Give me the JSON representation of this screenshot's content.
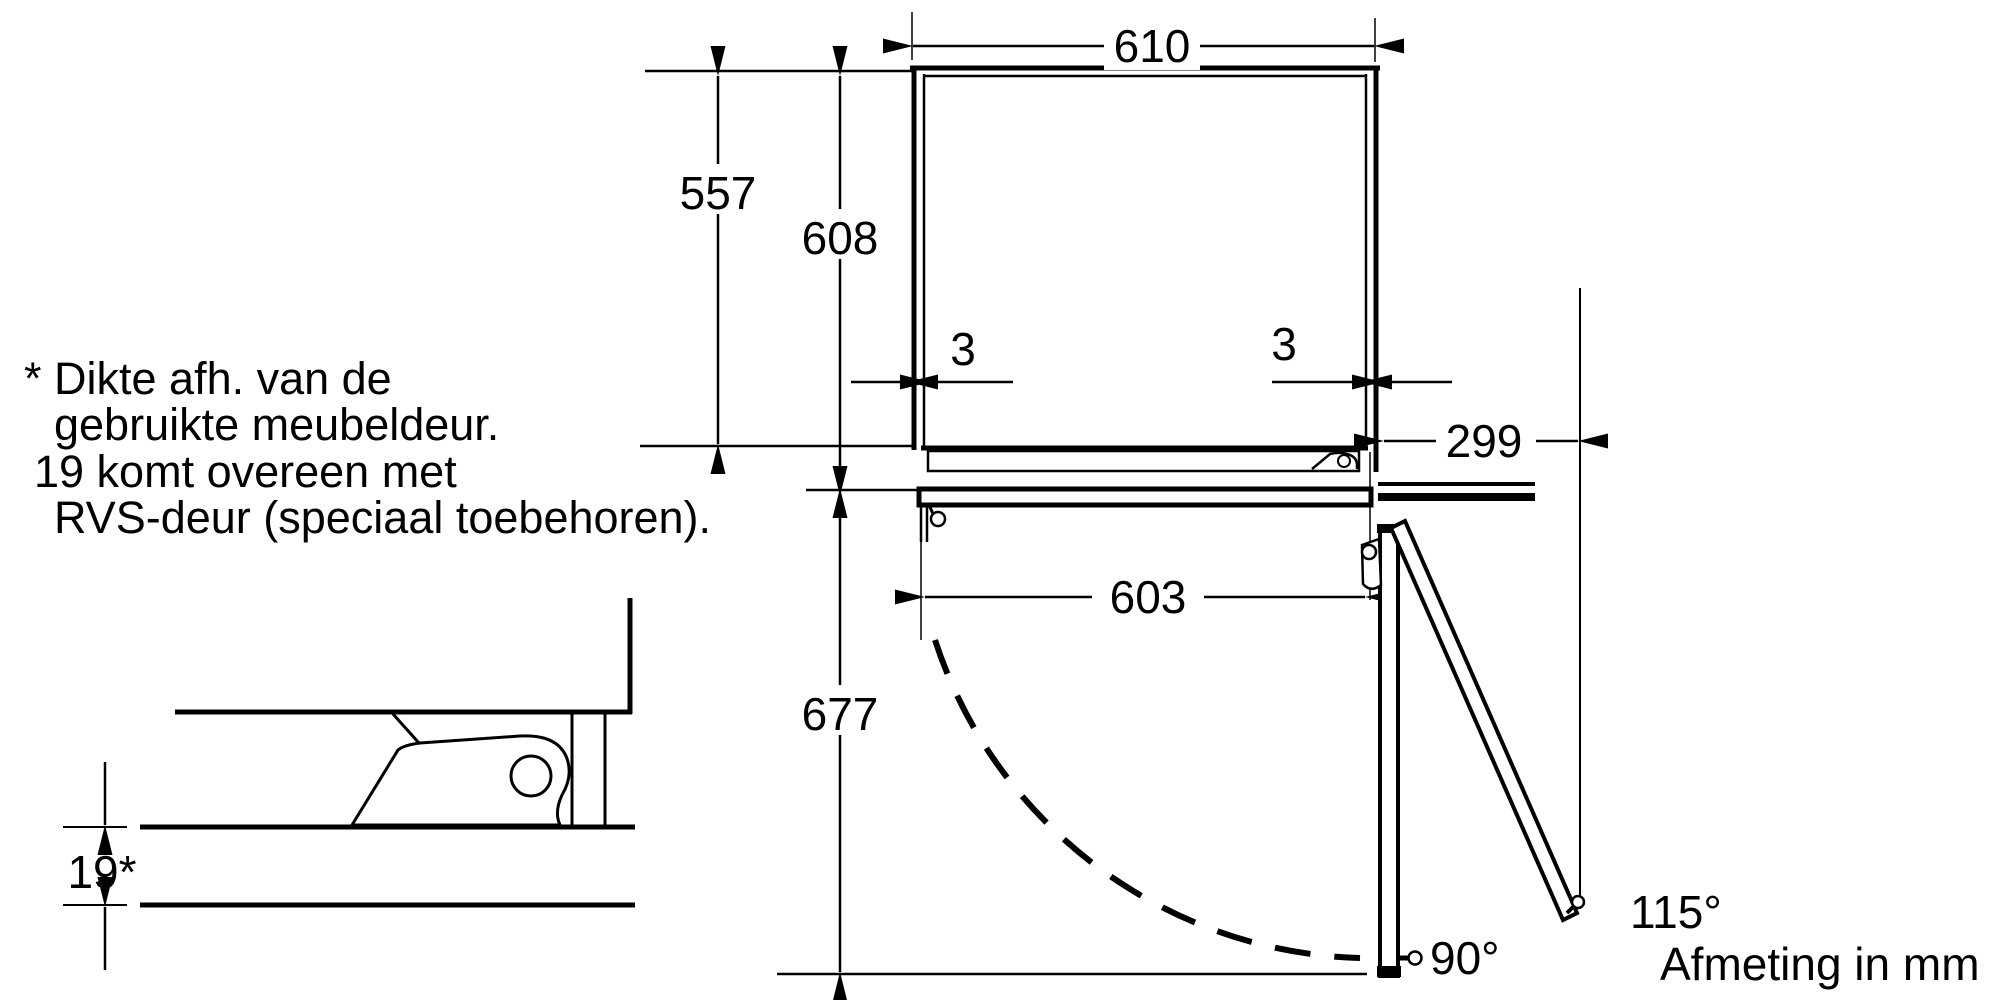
{
  "drawing": {
    "type": "appliance-installation-diagram",
    "units_label": "Afmeting in mm",
    "ink_color": "#000000",
    "background_color": "#ffffff"
  },
  "dimensions": {
    "niche_width": "610",
    "niche_depth": "557",
    "total_depth": "608",
    "side_gap_left": "3",
    "side_gap_right": "3",
    "side_clearance": "299",
    "door_width": "603",
    "door_swing_depth": "677",
    "panel_thickness": "19*",
    "opening_angle_90": "90°",
    "opening_angle_max": "115°"
  },
  "note": {
    "line1": "* Dikte afh. van de",
    "line2": "gebruikte meubeldeur.",
    "line3": "19 komt overeen met",
    "line4": "RVS-deur (speciaal toebehoren)."
  }
}
